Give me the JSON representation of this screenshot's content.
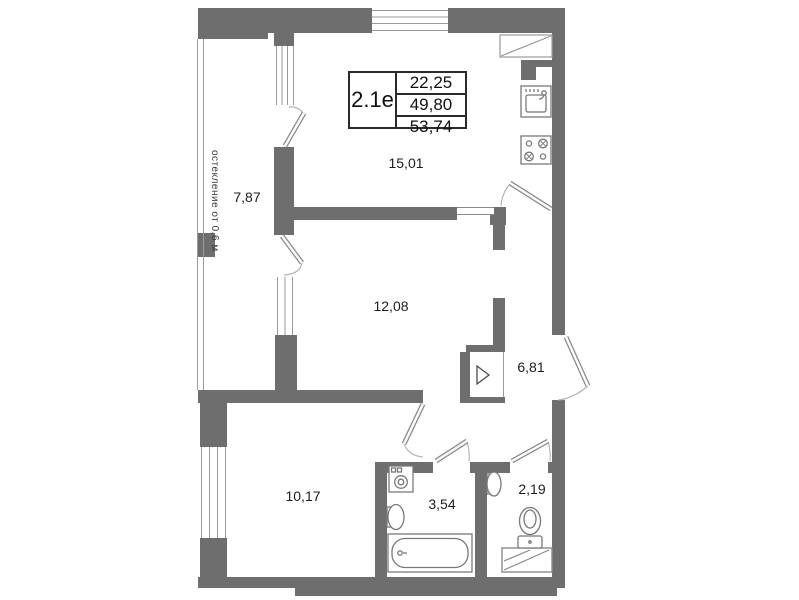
{
  "floor_plan": {
    "info_table": {
      "unit": "2.1е",
      "rows": [
        "22,25",
        "49,80",
        "53,74"
      ]
    },
    "glazing_note": "остекление от 0,6 м",
    "rooms": [
      {
        "id": "kitchen-living",
        "area": "15,01"
      },
      {
        "id": "loggia",
        "area": "7,87"
      },
      {
        "id": "bedroom-1",
        "area": "12,08"
      },
      {
        "id": "hall",
        "area": "6,81"
      },
      {
        "id": "bedroom-2",
        "area": "10,17"
      },
      {
        "id": "bathroom",
        "area": "3,54"
      },
      {
        "id": "wc",
        "area": "2,19"
      }
    ],
    "icons": {
      "kitchen-sink-icon": "square basin with faucet",
      "stove-icon": "four burner circles",
      "washing-machine-icon": "square with drum circle",
      "bathtub-icon": "rounded tub outline",
      "wash-basin-icon": "oval basin",
      "toilet-icon": "bowl with tank",
      "vent-shaft-icon": "box with diagonal",
      "panel-marker-icon": "▷"
    },
    "colors": {
      "wall": "#6e6e6e",
      "thin_line": "#9a9a9a",
      "text": "#1d1d1d"
    }
  }
}
